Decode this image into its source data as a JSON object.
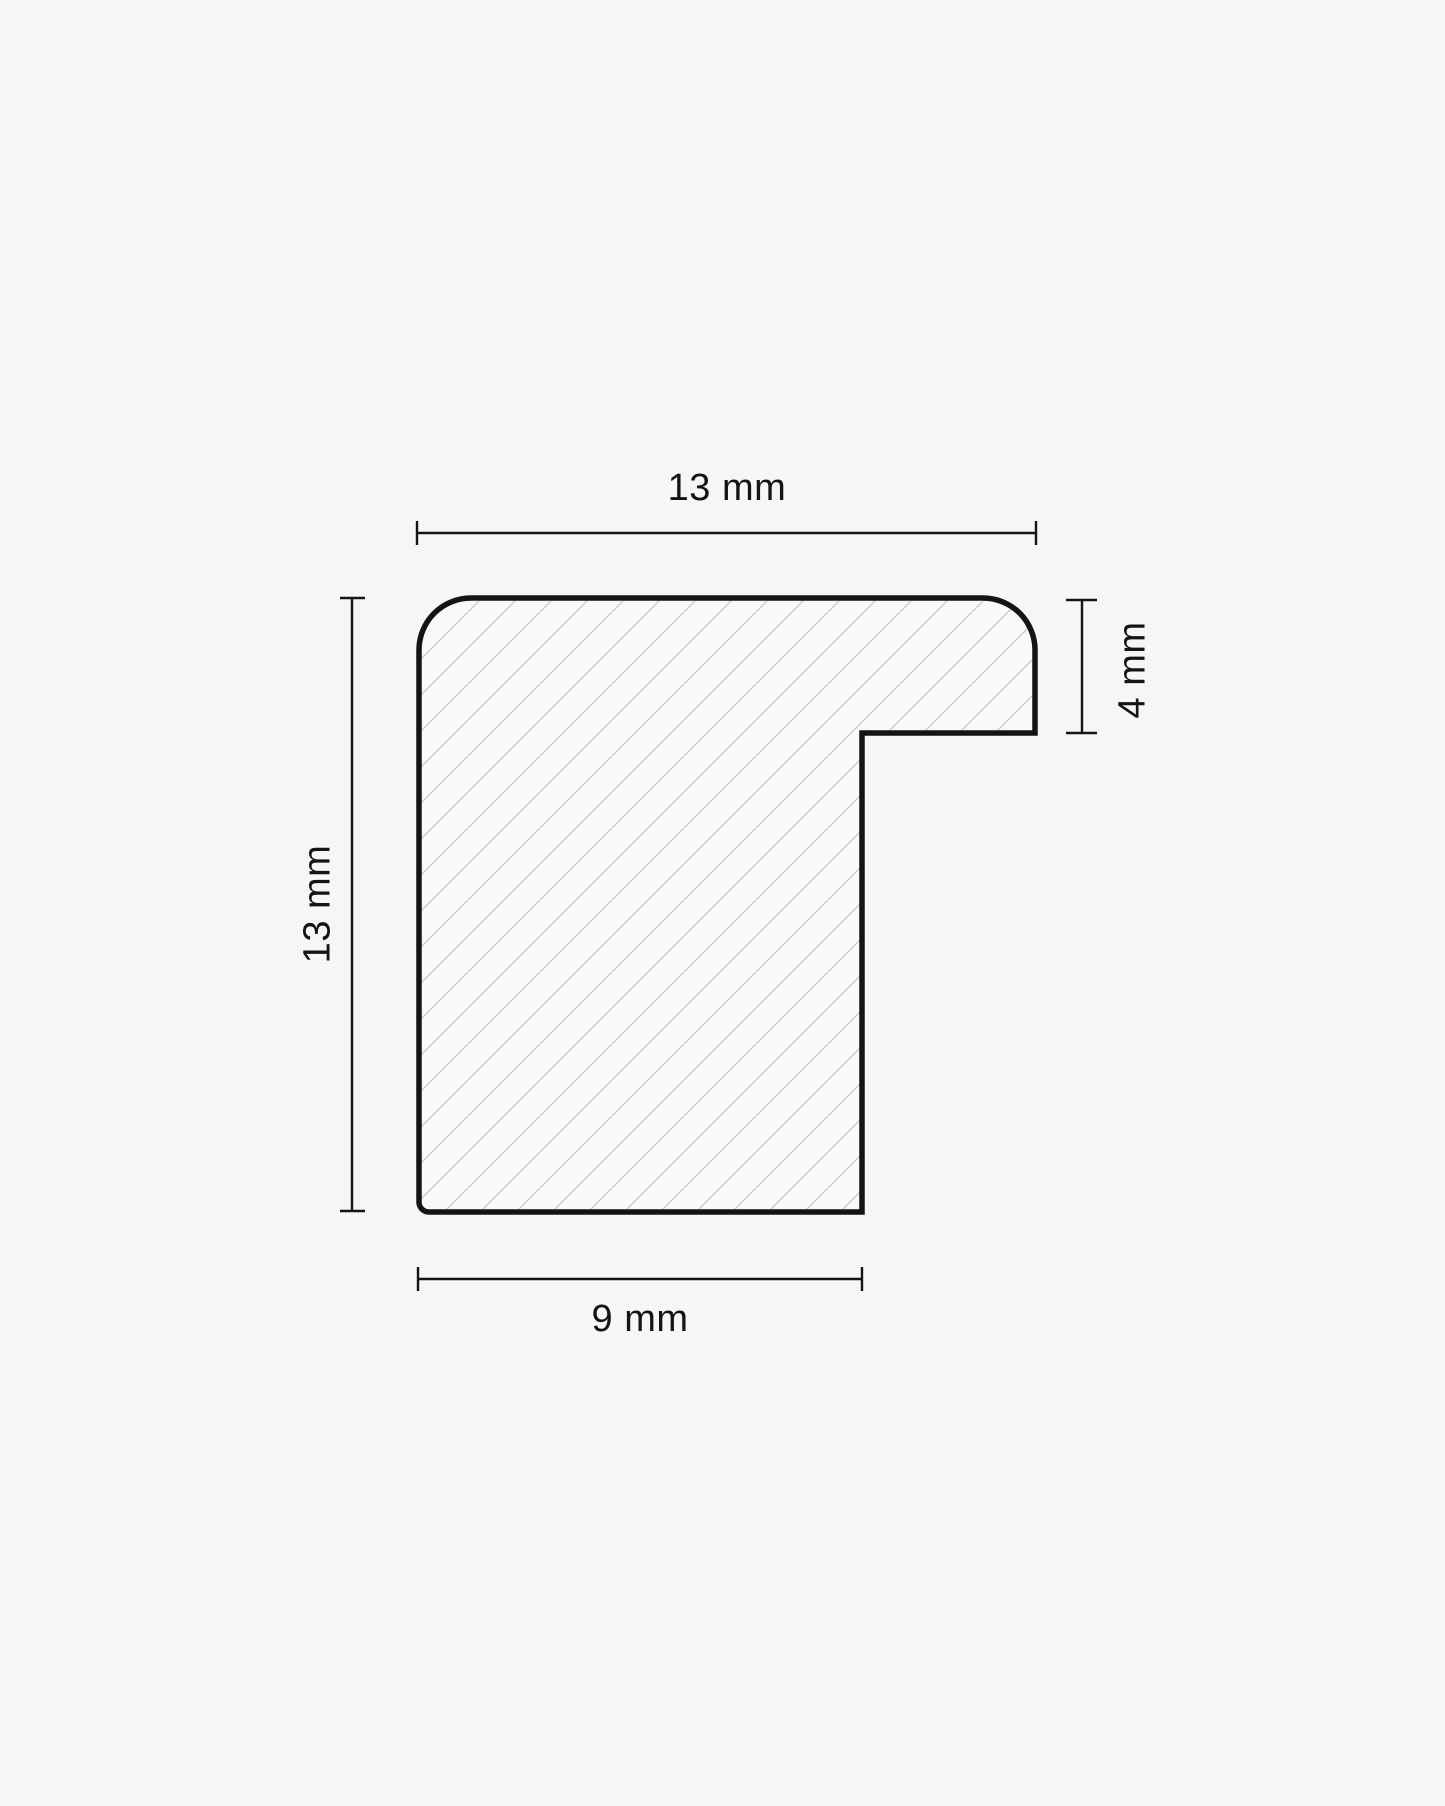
{
  "theme": {
    "bg": "#f6f6f8",
    "shape-fill": "#f9f9fa",
    "line": "#141414",
    "hatch": "#c9ccd0"
  },
  "diagram": {
    "dimensions": {
      "top": "13 mm",
      "left": "13 mm",
      "right": "4 mm",
      "bottom": "9 mm"
    }
  }
}
